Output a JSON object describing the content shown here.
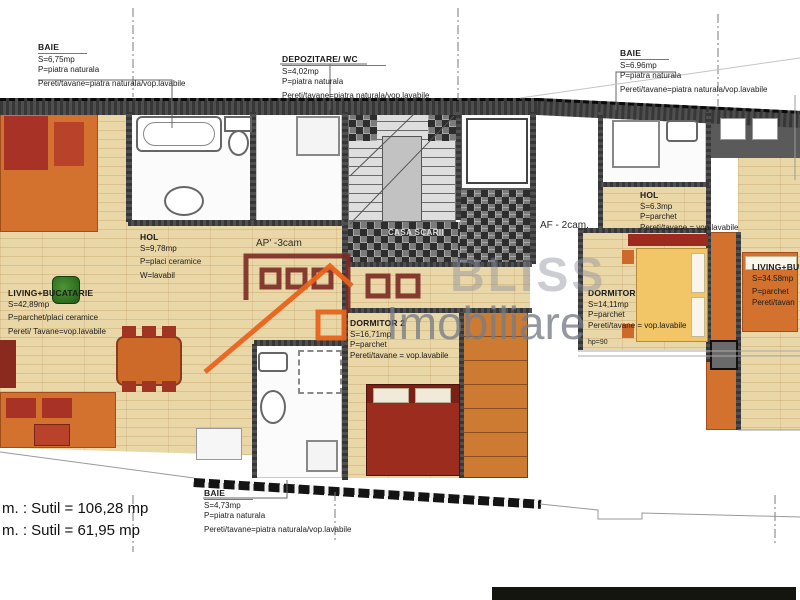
{
  "watermark": {
    "brand_top": "BLISS",
    "brand_bottom": "Imobiliare"
  },
  "rooms": [
    {
      "name": "BAIE",
      "area": "S=6,75mp",
      "floor": "P=piatra naturala",
      "walls": "Pereti/tavane=piatra naturala/vop.lavabile"
    },
    {
      "name": "DEPOZITARE/ WC",
      "area": "S=4,02mp",
      "floor": "P=piatra naturala",
      "walls": "Pereti/tavane=piatra naturala/vop.lavabile"
    },
    {
      "name": "BAIE",
      "area": "S=6.96mp",
      "floor": "P=piatra naturala",
      "walls": "Pereti/tavane=piatra naturala/vop.lavabile"
    },
    {
      "name": "HOL",
      "area": "S=9,78mp",
      "floor": "P=placi ceramice",
      "walls": "W=lavabil"
    },
    {
      "name": "LIVING+BUCATARIE",
      "area": "S=42,89mp",
      "floor": "P=parchet/placi ceramice",
      "walls": "Pereti/ Tavane=vop.lavabile"
    },
    {
      "name": "DORMITOR 2",
      "area": "S=16,71mp",
      "floor": "P=parchet",
      "walls": "Pereti/tavane = vop.lavabile"
    },
    {
      "name": "HOL",
      "area": "S=6.3mp",
      "floor": "P=parchet",
      "walls": "Pereti/tavane = vop.lavabile"
    },
    {
      "name": "DORMITOR",
      "area": "S=14,11mp",
      "floor": "P=parchet",
      "walls": "Pereti/tavane = vop.lavabile"
    },
    {
      "name": "LIVING+BU",
      "area": "S=34.58mp",
      "floor": "P=parchet",
      "walls": "Pereti/tavan"
    },
    {
      "name": "BAIE",
      "area": "S=4,73mp",
      "floor": "P=piatra naturala",
      "walls": "Pereti/tavane=piatra naturala/vop.lavabile"
    }
  ],
  "annotations": {
    "apartment_3cam": "AP' -3cam",
    "apartment_2cam": "AF - 2cam.",
    "stairwell": "CASA SCARII",
    "parapet_height": "hp=90"
  },
  "totals": {
    "line1": "m. : Sutil = 106,28 mp",
    "line2": "m. : Sutil = 61,95 mp"
  },
  "colors": {
    "wall": "#4f4f4f",
    "wood_floor": "#ead7a7",
    "orange_floor": "#d2722e",
    "rug_red": "#a93226",
    "bed_yellow": "#f2c567",
    "bed_maroon": "#7c1f15",
    "watermark_gray": "#8d929b",
    "brand_orange": "#e8641c",
    "brand_maroon": "#7c2b24"
  }
}
